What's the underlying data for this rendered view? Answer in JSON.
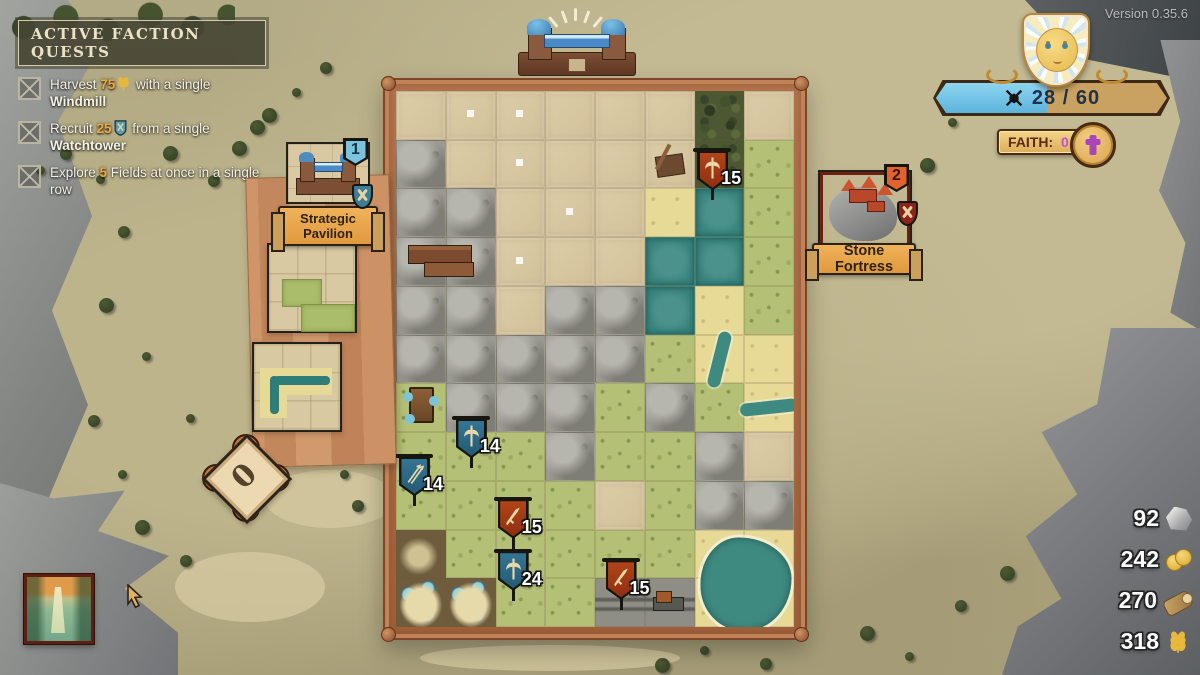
{
  "version": "Version 0.35.6",
  "quest_panel": {
    "title": "ACTIVE FACTION QUESTS",
    "quests": [
      {
        "pre": "Harvest ",
        "amount": "75",
        "icon": "wheat",
        "mid": " with a single ",
        "bold": "Windmill"
      },
      {
        "pre": "Recruit ",
        "amount": "25",
        "icon": "recruit-shield",
        "mid": " from a single ",
        "bold": "Watchtower"
      },
      {
        "pre": "Explore ",
        "amount": "5",
        "icon": "",
        "mid": " Fields at once in a single row",
        "bold": ""
      }
    ]
  },
  "hud": {
    "score": "28 / 60",
    "score_fill_pct": 48,
    "faith_label": "FAITH:",
    "faith_value": "0",
    "deck_count": "0"
  },
  "cards": {
    "pavilion": {
      "name": "Strategic Pavilion",
      "badge": "1"
    },
    "fortress": {
      "name": "Stone Fortress",
      "badge": "2"
    }
  },
  "resources": [
    {
      "name": "stone",
      "value": "92"
    },
    {
      "name": "coins",
      "value": "242"
    },
    {
      "name": "wood",
      "value": "270"
    },
    {
      "name": "wheat",
      "value": "318"
    }
  ],
  "board": {
    "grid": [
      "ttttttdt",
      "mtttttdg",
      "mmtttswg",
      "mmtttwwg",
      "mmtmmwsg",
      "mmmmmgss",
      "gmmmgmgs",
      "gggmggmt",
      "ggggtgmm",
      "bgggggss",
      "bbggrrss"
    ],
    "banners": [
      {
        "value": "15",
        "color": "red",
        "icon": "axe",
        "x_pct": 75.4,
        "y_pct": 10.7
      },
      {
        "value": "14",
        "color": "blue",
        "icon": "axe",
        "x_pct": 14.8,
        "y_pct": 60.7
      },
      {
        "value": "14",
        "color": "blue",
        "icon": "arrows",
        "x_pct": 0.5,
        "y_pct": 67.8
      },
      {
        "value": "15",
        "color": "red",
        "icon": "sword",
        "x_pct": 25.3,
        "y_pct": 75.7
      },
      {
        "value": "24",
        "color": "blue",
        "icon": "axe",
        "x_pct": 25.3,
        "y_pct": 85.4
      },
      {
        "value": "15",
        "color": "red",
        "icon": "sword",
        "x_pct": 52.4,
        "y_pct": 87.1
      }
    ],
    "props": [
      {
        "type": "trees",
        "col": 6,
        "row": 0
      },
      {
        "type": "trees",
        "col": 6,
        "row": 1
      },
      {
        "type": "catapult",
        "col": 5,
        "row": 1
      },
      {
        "type": "village",
        "col": 0,
        "row": 3
      },
      {
        "type": "tower",
        "col": 0,
        "row": 6
      },
      {
        "type": "river-v",
        "col": 6,
        "row": 5
      },
      {
        "type": "river-h",
        "col": 7,
        "row": 6
      },
      {
        "type": "pond",
        "col": 6,
        "row": 9
      },
      {
        "type": "tents",
        "col": 0,
        "row": 10
      },
      {
        "type": "tents",
        "col": 1,
        "row": 10
      },
      {
        "type": "cart",
        "col": 5,
        "row": 10
      },
      {
        "type": "sparkle",
        "col": 1,
        "row": 0
      },
      {
        "type": "sparkle",
        "col": 2,
        "row": 0
      },
      {
        "type": "sparkle",
        "col": 2,
        "row": 1
      },
      {
        "type": "sparkle",
        "col": 3,
        "row": 2
      },
      {
        "type": "sparkle",
        "col": 2,
        "row": 3
      }
    ]
  },
  "colors": {
    "quest_amount": "#f2a83c",
    "faith_value": "#c44fd0",
    "progress_fill": "#6ec6ea",
    "banner_blue": "#2f6b88",
    "banner_red": "#a33b1a"
  }
}
